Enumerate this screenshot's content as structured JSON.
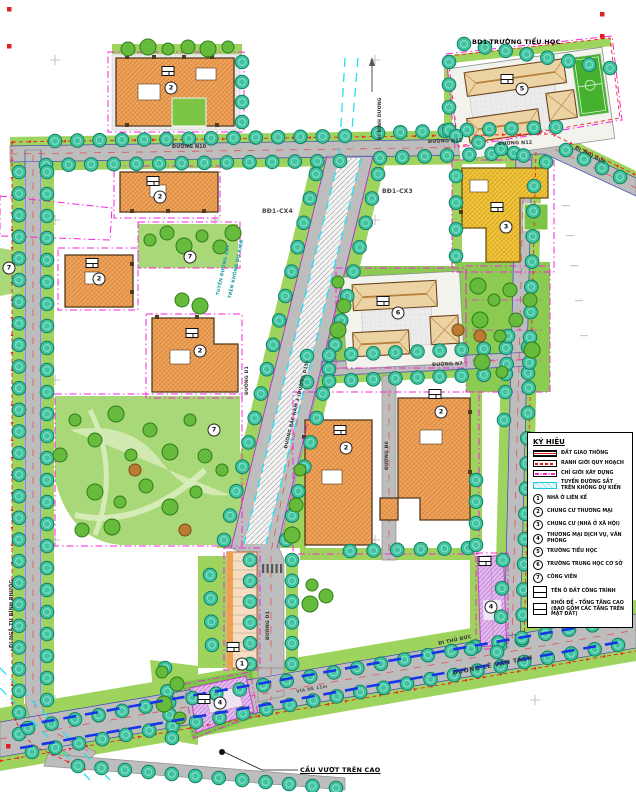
{
  "labels": {
    "school_title": "BD1-TRƯỜNG TIỂU HỌC",
    "block_cx4": "BĐ1-CX4",
    "block_cx3": "BĐ1-CX3",
    "road_n10": "ĐƯỜNG N10",
    "road_n12": "ĐƯỜNG N12",
    "road_n7": "ĐƯỜNG N7",
    "road_n6": "ĐƯỜNG N6",
    "road_d1": "ĐƯỜNG D1",
    "road_bac_nam": "ĐƯỜNG BẮC NAM 3 (ĐƯỜNG D15)",
    "railway_1": "TUYẾN ĐƯỜNG SẮT",
    "railway_2": "TRÊN KHÔNG DỰ KIẾN",
    "dir_binh_duong": "ĐI BÌNH DƯƠNG",
    "dir_thu_duc": "ĐI THỦ ĐỨC",
    "dir_nga_tu": "ĐI NGÃ TƯ BÌNH PHƯỚC",
    "overpass": "CẦU VƯỢT TRÊN CAO",
    "road_le_van_tach": "ĐƯỜNG LÊ VĂN TÁCH",
    "sidewalk": "VỈA HÈ 11m"
  },
  "legend": {
    "title": "KÝ HIỆU",
    "line_items": [
      {
        "symbol": "road-swatch",
        "label": "ĐẤT GIAO THÔNG"
      },
      {
        "symbol": "red-boundary-swatch",
        "label": "RANH GIỚI QUY HOẠCH"
      },
      {
        "symbol": "magenta-boundary-swatch",
        "label": "CHỈ GIỚI XÂY DỰNG"
      },
      {
        "symbol": "railway-swatch",
        "label": "TUYẾN ĐƯỜNG SẮT TRÊN KHÔNG DỰ KIẾN"
      }
    ],
    "numbered_items": [
      {
        "n": "1",
        "label": "NHÀ Ở LIÊN KẾ"
      },
      {
        "n": "2",
        "label": "CHUNG CƯ THƯƠNG MẠI"
      },
      {
        "n": "3",
        "label": "CHUNG CƯ (NHÀ Ở XÃ HỘI)"
      },
      {
        "n": "4",
        "label": "THƯƠNG MẠI DỊCH VỤ, VĂN PHÒNG"
      },
      {
        "n": "5",
        "label": "TRƯỜNG TIỂU HỌC"
      },
      {
        "n": "6",
        "label": "TRƯỜNG TRUNG HỌC CƠ SỞ"
      },
      {
        "n": "7",
        "label": "CÔNG VIÊN"
      }
    ],
    "notes": [
      {
        "label": "TÊN Ô ĐẤT CÔNG TRÌNH"
      },
      {
        "label": "KHỐI ĐẾ - TỔNG TẦNG CAO (BAO GỒM CÁC TẦNG TRÊN MẶT ĐẤT)"
      }
    ]
  },
  "markers": [
    {
      "n": "2"
    },
    {
      "n": "2"
    },
    {
      "n": "2"
    },
    {
      "n": "2"
    },
    {
      "n": "3"
    },
    {
      "n": "6"
    },
    {
      "n": "5"
    },
    {
      "n": "2"
    },
    {
      "n": "2"
    },
    {
      "n": "1"
    },
    {
      "n": "4"
    },
    {
      "n": "4"
    },
    {
      "n": "7"
    },
    {
      "n": "7"
    },
    {
      "n": "7"
    }
  ],
  "colors": {
    "street_tree": "#3fc4a0",
    "park_green": "#8ccb52",
    "building_orange": "#f2a85e",
    "building_yellow": "#f3c73f",
    "building_purple": "#e3bbee",
    "boundary_magenta": "#f524d8",
    "boundary_red": "#f02020",
    "railway_cyan": "#25dff2",
    "overpass_blue": "#1535e8",
    "road_gray": "#bdbdbd"
  }
}
